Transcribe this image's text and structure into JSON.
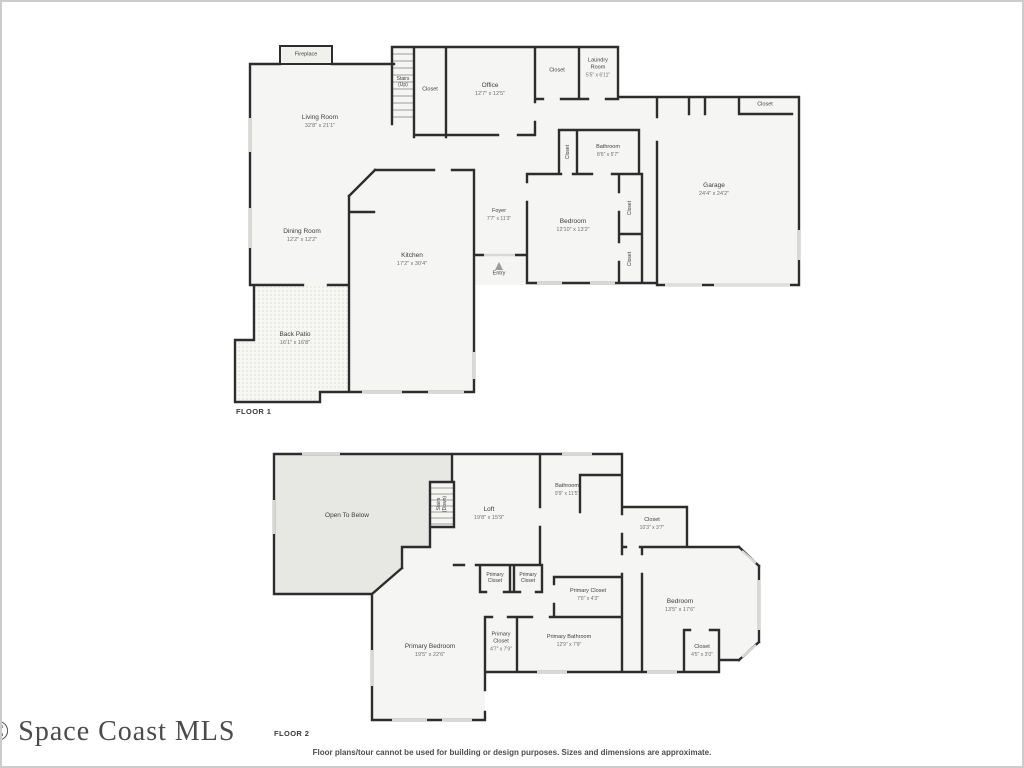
{
  "meta": {
    "watermark": "© Space Coast MLS",
    "disclaimer": "Floor plans/tour cannot be used for building or design purposes. Sizes and dimensions are approximate."
  },
  "colors": {
    "wall": "#2d2d2d",
    "room_fill": "#f5f5f3",
    "open_to_below_fill": "#e7e7e4",
    "window": "#d8d8d5",
    "label_text": "#3e3e3e",
    "dims_text": "#6f6f6f"
  },
  "floors": [
    {
      "name": "FLOOR 1",
      "name_pos": {
        "x": 234,
        "y": 405
      },
      "rooms": [
        {
          "id": "fireplace",
          "label": "Fireplace",
          "x": 304,
          "y": 53,
          "size": "xs"
        },
        {
          "id": "living-room",
          "label": "Living Room",
          "dims": "32'8\" x 21'1\"",
          "x": 318,
          "y": 120
        },
        {
          "id": "stairs-up",
          "label": "Stairs\n(Up)",
          "x": 401,
          "y": 80,
          "size": "xxs"
        },
        {
          "id": "stairs-closet",
          "label": "Closet",
          "x": 428,
          "y": 88,
          "size": "xs"
        },
        {
          "id": "office",
          "label": "Office",
          "dims": "12'7\" x 12'5\"",
          "x": 488,
          "y": 88
        },
        {
          "id": "hall-closet",
          "label": "Closet",
          "x": 555,
          "y": 69,
          "size": "xs"
        },
        {
          "id": "laundry-room",
          "label": "Laundry\nRoom",
          "dims": "5'5\" x 6'11\"",
          "x": 596,
          "y": 66,
          "size": "xs"
        },
        {
          "id": "garage-closet",
          "label": "Closet",
          "x": 763,
          "y": 103,
          "size": "xs"
        },
        {
          "id": "garage",
          "label": "Garage",
          "dims": "24'4\" x 24'2\"",
          "x": 712,
          "y": 188
        },
        {
          "id": "bathroom",
          "label": "Bathroom",
          "dims": "8'6\" x 5'7\"",
          "x": 606,
          "y": 149,
          "size": "xs"
        },
        {
          "id": "bathroom-closet",
          "label": "Closet",
          "x": 566,
          "y": 150,
          "rot": true,
          "size": "xxs"
        },
        {
          "id": "bedroom",
          "label": "Bedroom",
          "dims": "12'10\" x 13'2\"",
          "x": 571,
          "y": 224
        },
        {
          "id": "bedroom-closet-1",
          "label": "Closet",
          "x": 628,
          "y": 206,
          "rot": true,
          "size": "xxs"
        },
        {
          "id": "bedroom-closet-2",
          "label": "Closet",
          "x": 628,
          "y": 257,
          "rot": true,
          "size": "xxs"
        },
        {
          "id": "foyer",
          "label": "Foyer",
          "dims": "7'7\" x 11'3\"",
          "x": 497,
          "y": 213,
          "size": "xs"
        },
        {
          "id": "entry",
          "label": "Entry",
          "x": 497,
          "y": 272,
          "size": "xs"
        },
        {
          "id": "kitchen",
          "label": "Kitchen",
          "dims": "17'2\" x 30'4\"",
          "x": 410,
          "y": 258
        },
        {
          "id": "dining-room",
          "label": "Dining Room",
          "dims": "12'2\" x 12'2\"",
          "x": 300,
          "y": 234
        },
        {
          "id": "back-patio",
          "label": "Back Patio",
          "dims": "16'1\" x 16'8\"",
          "x": 293,
          "y": 337
        }
      ]
    },
    {
      "name": "FLOOR 2",
      "name_pos": {
        "x": 272,
        "y": 727
      },
      "rooms": [
        {
          "id": "open-to-below",
          "label": "Open To Below",
          "x": 345,
          "y": 514
        },
        {
          "id": "stairs-down",
          "label": "Stairs\n(Down)",
          "x": 440,
          "y": 502,
          "rot": true,
          "size": "xxs"
        },
        {
          "id": "loft",
          "label": "Loft",
          "dims": "19'8\" x 15'9\"",
          "x": 487,
          "y": 512
        },
        {
          "id": "bathroom",
          "label": "Bathroom",
          "dims": "9'9\" x 11'5\"",
          "x": 565,
          "y": 488,
          "size": "xs"
        },
        {
          "id": "closet",
          "label": "Closet",
          "dims": "10'3\" x 3'7\"",
          "x": 650,
          "y": 522,
          "size": "xs"
        },
        {
          "id": "primary-closet-a",
          "label": "Primary\nCloset",
          "x": 493,
          "y": 576,
          "size": "xxs"
        },
        {
          "id": "primary-closet-b",
          "label": "Primary\nCloset",
          "x": 526,
          "y": 576,
          "size": "xxs"
        },
        {
          "id": "primary-closet",
          "label": "Primary Closet",
          "dims": "7'0\" x 4'3\"",
          "x": 586,
          "y": 593,
          "size": "xs"
        },
        {
          "id": "bedroom",
          "label": "Bedroom",
          "dims": "13'5\" x 17'6\"",
          "x": 678,
          "y": 604
        },
        {
          "id": "bedroom-closet",
          "label": "Closet",
          "dims": "4'5\" x 3'0\"",
          "x": 700,
          "y": 649,
          "size": "xs"
        },
        {
          "id": "primary-bedroom",
          "label": "Primary Bedroom",
          "dims": "19'5\" x 22'6\"",
          "x": 428,
          "y": 649
        },
        {
          "id": "primary-closet-bath",
          "label": "Primary\nCloset",
          "dims": "4'7\" x 7'9\"",
          "x": 499,
          "y": 640,
          "size": "xs"
        },
        {
          "id": "primary-bathroom",
          "label": "Primary Bathroom",
          "dims": "12'9\" x 7'9\"",
          "x": 567,
          "y": 639,
          "size": "xs"
        }
      ]
    }
  ]
}
